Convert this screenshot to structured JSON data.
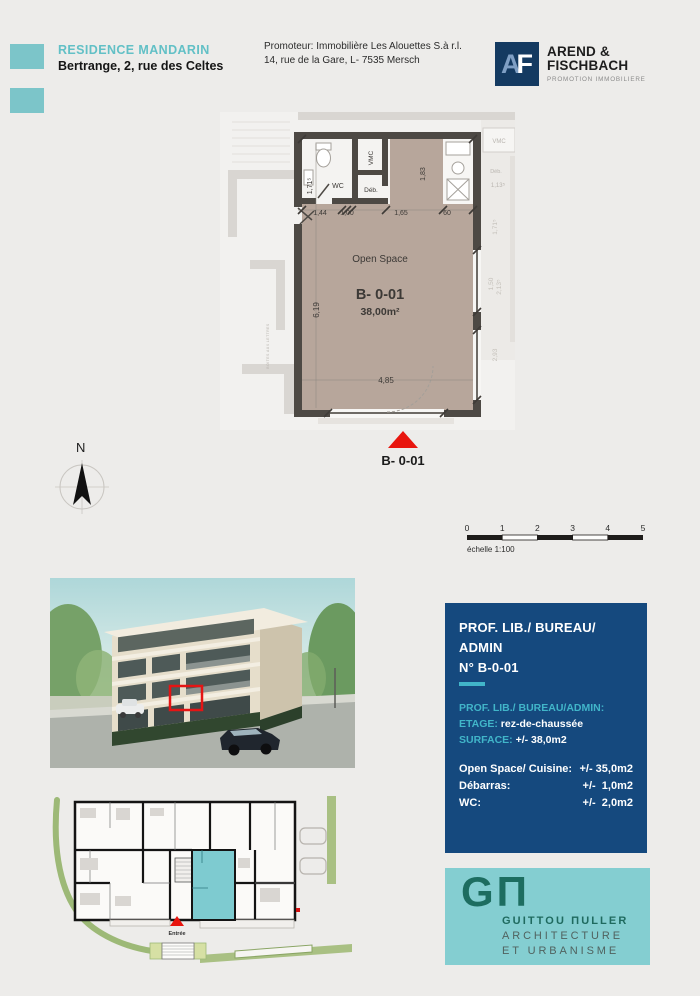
{
  "header": {
    "project_title": "RESIDENCE MANDARIN",
    "project_address": "Bertrange, 2, rue des Celtes",
    "promoter_line1": "Promoteur: Immobilière Les Alouettes S.à r.l.",
    "promoter_line2": "14, rue de la Gare, L- 7535 Mersch",
    "logo": {
      "a": "A",
      "f": "F"
    },
    "developer_name_line1": "AREND &",
    "developer_name_line2": "FISCHBACH",
    "developer_tagline": "PROMOTION IMMOBILIERE"
  },
  "floor_plan": {
    "labels": {
      "open_space": "Open Space",
      "wc": "WC",
      "vmc": "VMC",
      "deb": "Déb."
    },
    "unit_id": "B- 0-01",
    "area": "38,00m²",
    "dims": {
      "d171": "1,71⁵",
      "d144": "1,44",
      "d100": "1,00",
      "d165": "1,65",
      "d60": "60",
      "d183": "1,83",
      "d619": "6,19",
      "d485": "4,85"
    },
    "neighbor": {
      "vmc": "VMC",
      "deb": "Déb.",
      "d113": "1,13⁵",
      "side_dims": [
        "1,71⁵",
        "1,50",
        "2,13⁵",
        "2,93"
      ]
    },
    "mailboxes_label": "BOITES AUX LETTRES",
    "marker_label": "B- 0-01"
  },
  "compass": {
    "label": "N"
  },
  "scale_bar": {
    "ticks": [
      "0",
      "1",
      "2",
      "3",
      "4",
      "5"
    ],
    "caption": "échelle 1:100"
  },
  "site_plan": {
    "entrance_label": "Entrée"
  },
  "info_box": {
    "title_line1": "PROF. LIB./ BUREAU/ ADMIN",
    "title_line2": "N° B-0-01",
    "category_label": "PROF. LIB./ BUREAU/ADMIN:",
    "etage_label": "ETAGE:",
    "etage_value": " rez-de-chaussée",
    "surface_label": "SURFACE:",
    "surface_value": " +/- 38,0m2",
    "rooms": [
      {
        "label": "Open Space/ Cuisine:",
        "value": "+/- 35,0m2"
      },
      {
        "label": "Débarras:",
        "value": "+/-  1,0m2"
      },
      {
        "label": "WC:",
        "value": "+/-  2,0m2"
      }
    ]
  },
  "architect_logo": {
    "mono_g": "G",
    "mono_pi": "Π",
    "name": "GUITTOU ΠULLER",
    "line2": "ARCHITECTURE",
    "line3": "ET URBANISME"
  },
  "colors": {
    "accent_teal": "#7cc5c9",
    "navy": "#15497e",
    "info_teal": "#41b5c9",
    "room_taupe": "#b7a69b",
    "wall": "#4d4944",
    "red": "#e8150e",
    "gm_green": "#1d6d60"
  }
}
